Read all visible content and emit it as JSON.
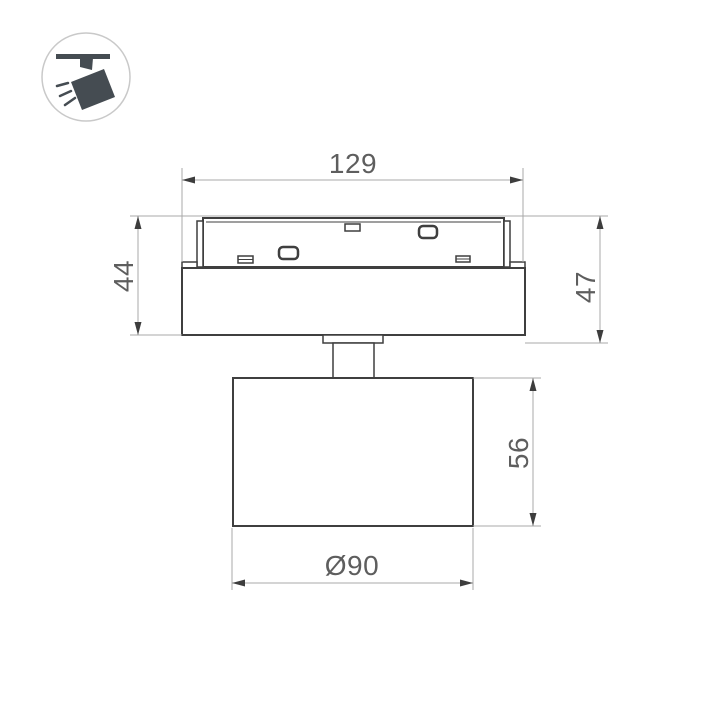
{
  "icon": {
    "name": "track-spotlight-icon",
    "color": "#454c52",
    "circle_stroke": "#c9c9c9"
  },
  "dimensions": {
    "overall_width": "129",
    "adapter_body_height": "44",
    "overall_mount_height": "47",
    "head_height": "56",
    "head_diameter": "Ø90"
  },
  "colors": {
    "background": "#ffffff",
    "object_line": "#3f3f3f",
    "dimension_line": "#a8a8a8",
    "arrow": "#3d3d3d",
    "text": "#5e5e5e"
  }
}
